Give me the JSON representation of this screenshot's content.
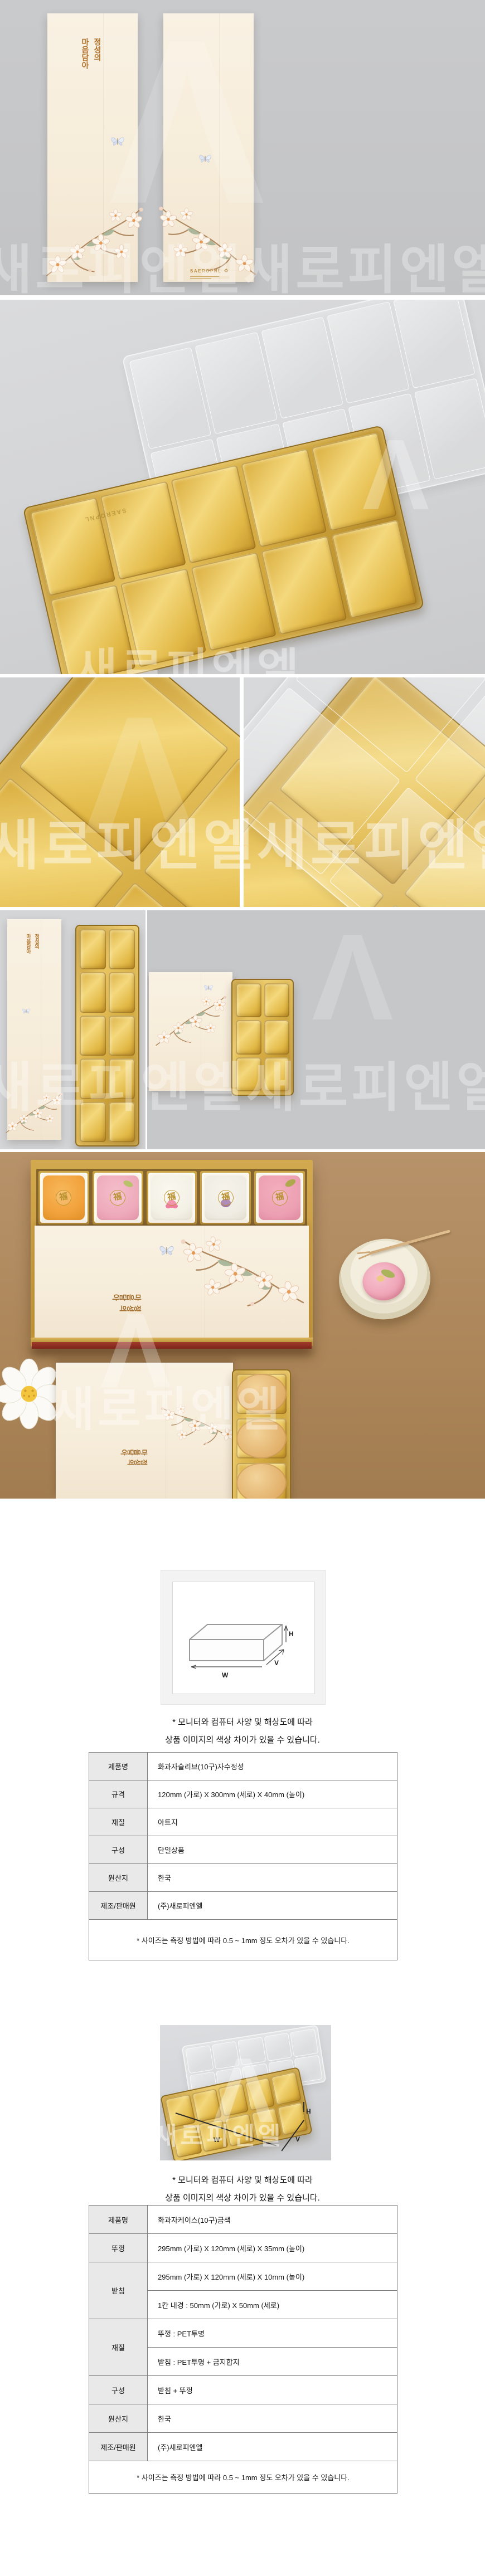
{
  "brand": {
    "watermark": "새로피엔엘",
    "watermark_repeat": "새로피엔엘새로피엔엘",
    "logo_text": "SAEROPNL",
    "logo_mark": "Λ",
    "recycle_icon": "♻"
  },
  "sleeve": {
    "col1": "정성의",
    "col2": "마음담아"
  },
  "sweets": {
    "fortune_mark": "福"
  },
  "diagram": {
    "width_label": "W",
    "depth_label": "V",
    "height_label": "H"
  },
  "notes": {
    "monitor_line1": "* 모니터와 컴퓨터 사양 및 해상도에 따라",
    "monitor_line2": "상품 이미지의 색상 차이가 있을 수 있습니다.",
    "size_tolerance": "* 사이즈는 측정 방법에 따라 0.5 ~ 1mm 정도 오차가 있을 수 있습니다."
  },
  "table1": {
    "rows": [
      {
        "label": "제품명",
        "value": "화과자슬리브(10구)자수정성"
      },
      {
        "label": "규격",
        "value": "120mm (가로) X 300mm (세로) X 40mm (높이)"
      },
      {
        "label": "재질",
        "value": "아트지"
      },
      {
        "label": "구성",
        "value": "단일상품"
      },
      {
        "label": "원산지",
        "value": "한국"
      },
      {
        "label": "제조/판매원",
        "value": "(주)새로피엔엘"
      }
    ]
  },
  "table2": {
    "product_label": "제품명",
    "product_value": "화과자케이스(10구)금색",
    "lid_label": "뚜껑",
    "lid_value": "295mm (가로) X 120mm (세로) X 35mm (높이)",
    "base_label": "받침",
    "base_value_size": "295mm (가로) X 120mm (세로) X 10mm (높이)",
    "base_value_inner": "1칸 내경 : 50mm (가로) X 50mm (세로)",
    "material_label": "재질",
    "material_value_lid": "뚜껑 : PET투명",
    "material_value_base": "받침 : PET투명 + 금지합지",
    "composition_label": "구성",
    "composition_value": "받침 + 뚜껑",
    "origin_label": "원산지",
    "origin_value": "한국",
    "maker_label": "제조/판매원",
    "maker_value": "(주)새로피엔엘"
  },
  "colors": {
    "gold_tray": "#d4a943",
    "cream_sleeve": "#f7eede",
    "gold_text": "#b0742c",
    "red_box_accent": "#a03328",
    "lifestyle_bg": "#b08c60",
    "studio_bg": "#d2d3d5",
    "table_label_bg": "#e9e9e9",
    "sweet_colors": [
      "#f2a23c",
      "#eeaabb",
      "#f3f0e6",
      "#efece4",
      "#ec9fb2"
    ],
    "sweet_accent_purple": "#8e5a9e",
    "sweet_accent_pink": "#ef7fa0"
  }
}
